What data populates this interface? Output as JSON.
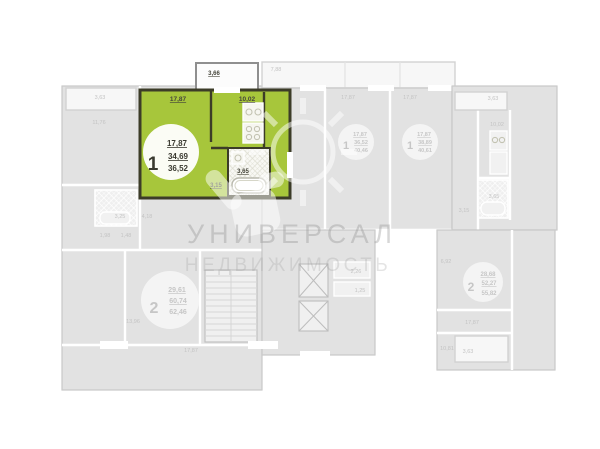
{
  "watermark": {
    "title": "УНИВЕРСАЛ",
    "subtitle": "НЕДВИЖИМОСТЬ"
  },
  "selected_apartment": {
    "rooms": "1",
    "living_area": "17,87",
    "area": "34,69",
    "total_area": "36,52",
    "balcony": "3,66",
    "room": "17,87",
    "kitchen": "10,02",
    "hall": "3,15",
    "bathroom": "3,65",
    "highlight_color": "#a7c63b"
  },
  "units": {
    "left_studio": {
      "balcony": "3,63",
      "room": "11,76",
      "bathroom": "3,25",
      "hall": "4,18",
      "wc": "1,98",
      "storage": "1,48"
    },
    "left_two_room": {
      "rooms": "2",
      "living_area": "29,61",
      "area": "60,74",
      "total_area": "62,46",
      "room_side": "13,96",
      "room_bottom": "17,87"
    },
    "mid_top_balcony": "7,88",
    "mid_unit_a": {
      "rooms": "1",
      "living_area": "17,87",
      "area": "36,52",
      "total_area": "40,46",
      "room": "17,87"
    },
    "mid_unit_b": {
      "rooms": "1",
      "living_area": "17,87",
      "area": "38,89",
      "total_area": "40,61",
      "room": "17,87"
    },
    "right_top_unit": {
      "balcony": "3,63",
      "kitchen": "10,02",
      "bathroom": "3,65",
      "hall": "3,15"
    },
    "right_two_room": {
      "rooms": "2",
      "living_area": "28,68",
      "area": "52,27",
      "total_area": "55,82",
      "hall": "6,92",
      "room": "17,87",
      "corridor": "10,81",
      "balcony": "3,63"
    },
    "core": {
      "shaft_a": "2,26",
      "shaft_b": "1,25"
    }
  }
}
